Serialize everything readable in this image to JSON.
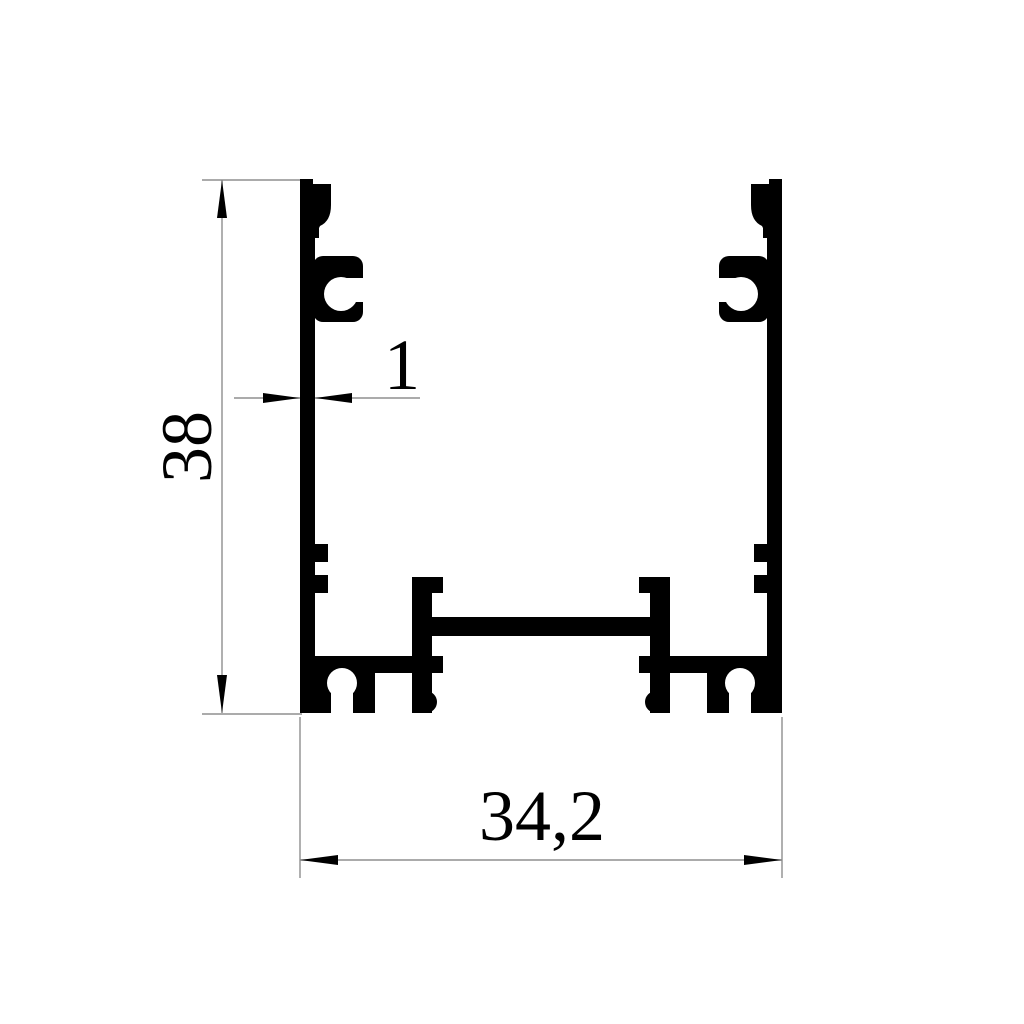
{
  "drawing": {
    "kind": "profile-cross-section-drawing",
    "dimensions": {
      "height": {
        "value": "38",
        "orientation": "vertical"
      },
      "wall_thickness": {
        "value": "1",
        "orientation": "horizontal"
      },
      "width": {
        "value": "34,2",
        "orientation": "horizontal"
      }
    },
    "colors": {
      "profile": "#000000",
      "dimension_lines": "#8f8f8f",
      "text": "#000000",
      "background": "#ffffff"
    }
  }
}
